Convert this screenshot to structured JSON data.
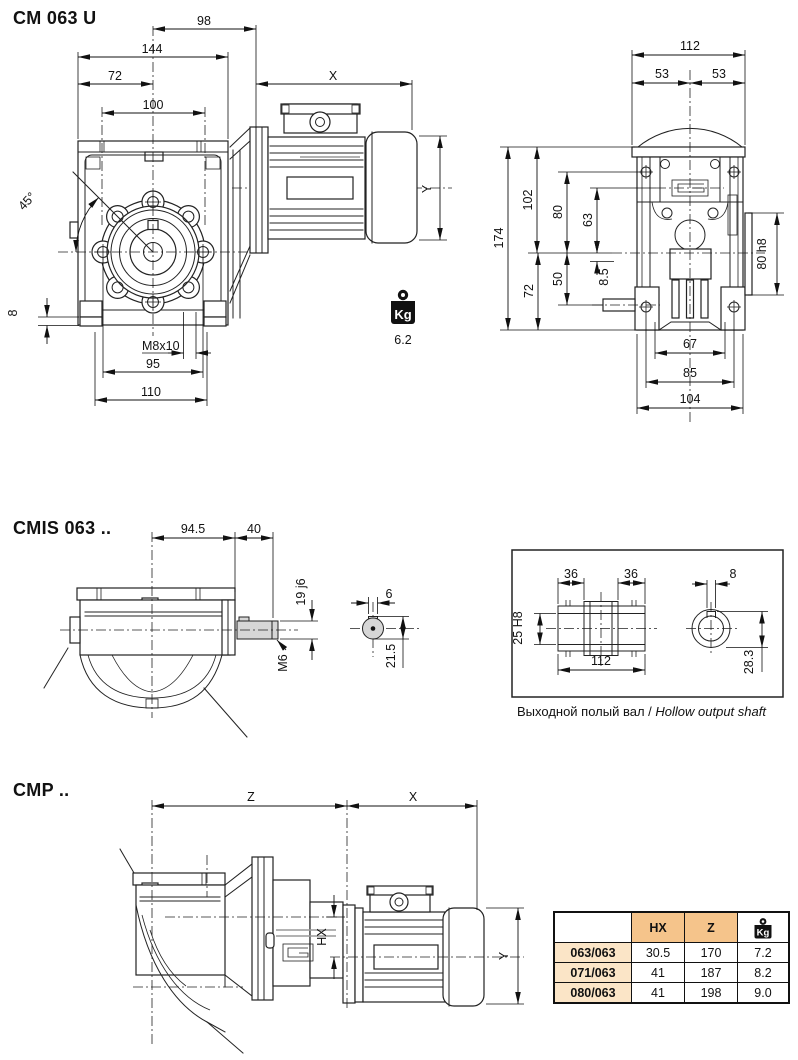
{
  "sections": {
    "cm063u": {
      "title": "CM 063 U",
      "front_view": {
        "d98": "98",
        "d144": "144",
        "d72": "72",
        "d100": "100",
        "d45": "45°",
        "dX": "X",
        "dY": "Y",
        "d8": "8",
        "m8x10": "M8x10",
        "d95": "95",
        "d110": "110"
      },
      "side_view": {
        "d112": "112",
        "d53l": "53",
        "d53r": "53",
        "d174": "174",
        "d102": "102",
        "d80": "80",
        "d63": "63",
        "d50": "50",
        "d8_5": "8.5",
        "d72": "72",
        "d80h8": "80 h8",
        "d67": "67",
        "d85": "85",
        "d104": "104"
      },
      "weight": {
        "icon_label": "Kg",
        "value": "6.2"
      }
    },
    "cmis063": {
      "title": "CMIS 063 ..",
      "side_view": {
        "d94_5": "94.5",
        "d40": "40",
        "d19j6": "19 j6",
        "m6": "M6"
      },
      "end_view": {
        "d6": "6",
        "d21_5": "21.5"
      },
      "hollow_shaft": {
        "caption_ru": "Выходной полый вал",
        "caption_sep": " / ",
        "caption_en": "Hollow output shaft",
        "dims": {
          "d36l": "36",
          "d36r": "36",
          "d8": "8",
          "d25h8": "25 H8",
          "d112": "112",
          "d28_3": "28.3"
        }
      }
    },
    "cmp": {
      "title": "CMP ..",
      "dims": {
        "dZ": "Z",
        "dX": "X",
        "dHX": "HX",
        "dY": "Y"
      },
      "table": {
        "col_model": "",
        "col_hx": "HX",
        "col_z": "Z",
        "kg_icon_label": "Kg",
        "rows": [
          {
            "model": "063/063",
            "hx": "30.5",
            "z": "170",
            "kg": "7.2"
          },
          {
            "model": "071/063",
            "hx": "41",
            "z": "187",
            "kg": "8.2"
          },
          {
            "model": "080/063",
            "hx": "41",
            "z": "198",
            "kg": "9.0"
          }
        ]
      }
    }
  },
  "colors": {
    "table_header_bg": "#F5C48B",
    "table_label_bg": "#FBE5C7",
    "line": "#1a1a1a"
  }
}
